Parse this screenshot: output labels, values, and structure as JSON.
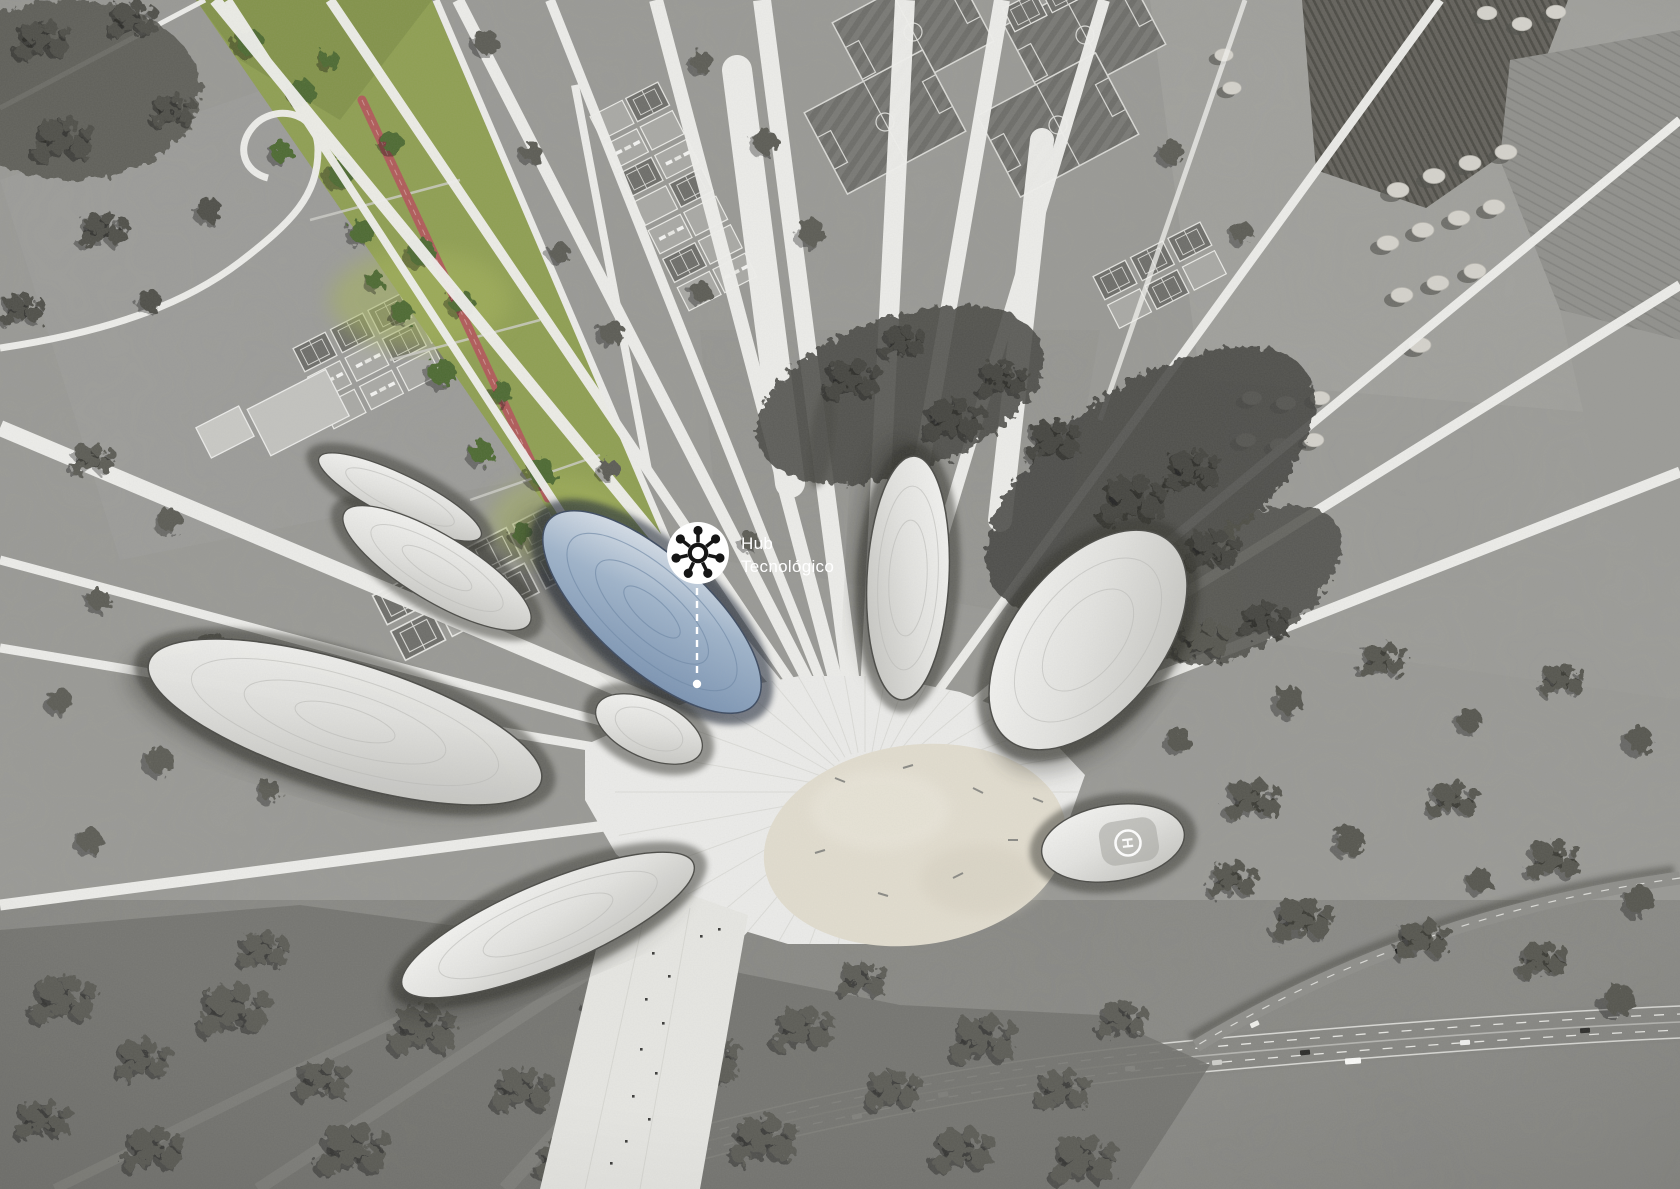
{
  "annotation": {
    "icon": "network-hub-icon",
    "label_line1": "Hub",
    "label_line2": "Tecnológico"
  },
  "helipad": {
    "letter": "H"
  },
  "colors": {
    "terrain_gray": "#9a9a96",
    "road_white": "#f1f1ee",
    "park_green": "#8f9f52",
    "park_green_dark": "#71843f",
    "track_red": "#b05b59",
    "hub_blue": "#9fb4cb",
    "hub_blue_deep": "#7a93b2",
    "plaza_pavement": "#ececea",
    "plaza_sand": "#e2ddcf",
    "shadow_dark": "#3a3a36"
  }
}
